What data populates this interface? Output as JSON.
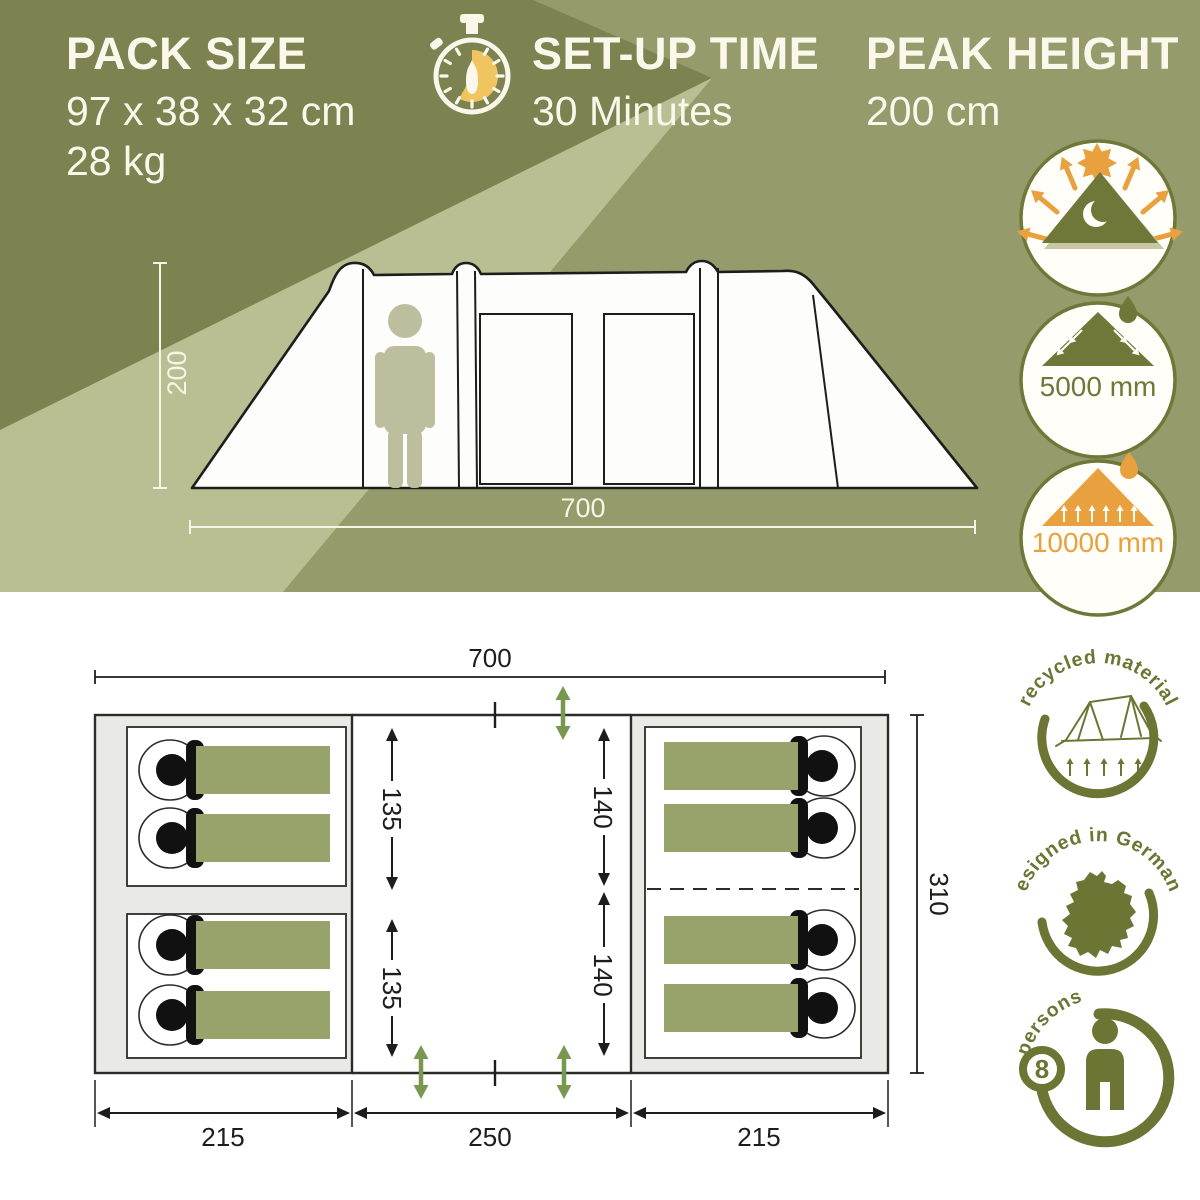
{
  "header": {
    "pack_size": {
      "title": "PACK SIZE",
      "dimensions": "97 x 38 x 32 cm",
      "weight": "28 kg"
    },
    "setup_time": {
      "title": "SET-UP TIME",
      "value": "30 Minutes"
    },
    "peak_height": {
      "title": "PEAK HEIGHT",
      "value": "200 cm"
    }
  },
  "side_view": {
    "height_label": "200",
    "width_label": "700"
  },
  "feature_icons": {
    "uv_tent": {
      "icon": "sun-reflecting-darkened-tent-icon"
    },
    "flysheet_water_column": {
      "label": "5000 mm",
      "icon": "rain-on-tent-icon"
    },
    "groundsheet_water_column": {
      "label": "10000 mm",
      "icon": "ground-water-tent-icon"
    }
  },
  "floor_plan": {
    "width_label": "700",
    "depth_label": "310",
    "bottom_labels": [
      "215",
      "250",
      "215"
    ],
    "cabin_depths": {
      "left_top": "135",
      "left_bottom": "135",
      "right_top": "140",
      "right_bottom": "140"
    },
    "sleeping_spots": 8
  },
  "badges": {
    "recycled": {
      "label": "recycled material",
      "icon": "line-tent-icon"
    },
    "germany": {
      "label": "designed in Germany",
      "icon": "germany-map-icon"
    },
    "persons": {
      "label": "persons",
      "count": "8",
      "icon": "person-icon"
    }
  },
  "colors": {
    "olive_base": "#959B6B",
    "olive_dark": "#7C8250",
    "olive_light": "#B9BF93",
    "ivory": "#FBF7EB",
    "orange": "#E8A13E",
    "yellow": "#F0C55F",
    "icon_olive": "#6F7838",
    "badge_olive": "#6C7533",
    "tan_shadow": "#C8C7A2",
    "bag_green": "#97A36B",
    "person_tan": "#BDBE9D",
    "entrance_green": "#79984F",
    "plan_gray": "#E9E9E6",
    "ink": "#1D1D1B",
    "white": "#FFFFFF"
  }
}
